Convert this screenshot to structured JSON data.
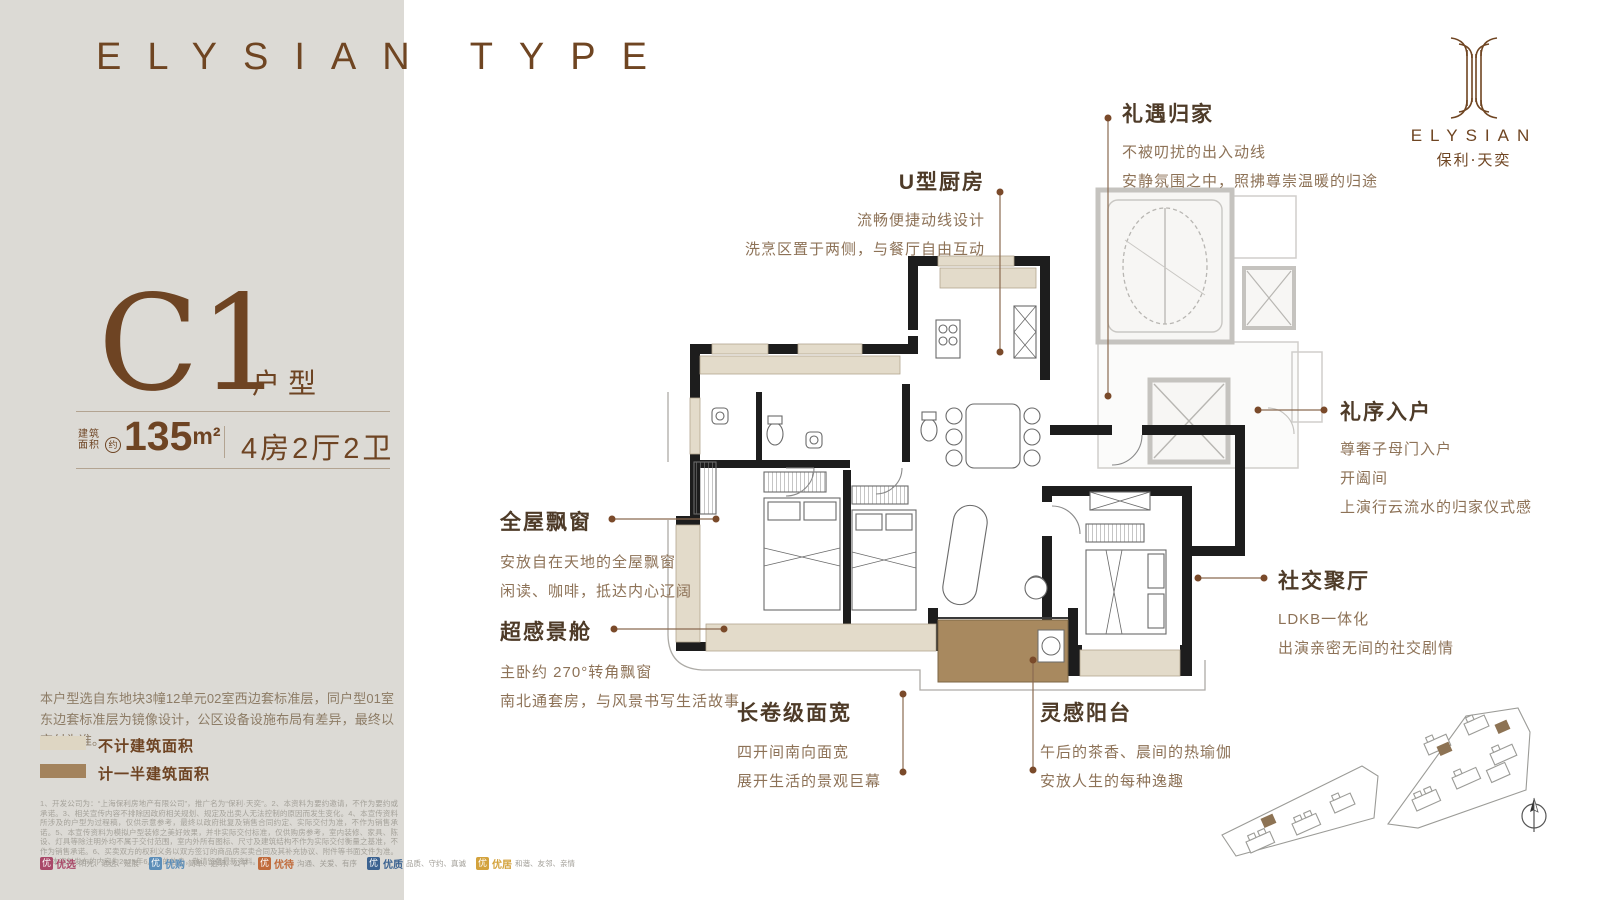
{
  "header": {
    "brand_left": "ELYSIAN",
    "brand_right": "TYPE"
  },
  "logo": {
    "name": "ELYSIAN",
    "cn": "保利·天奕"
  },
  "panel": {
    "plan_code": "C1",
    "plan_type_label": "户型",
    "area_label_1": "建筑",
    "area_label_2": "面积",
    "area_approx": "约",
    "area_value": "135",
    "area_unit": "m²",
    "layout_spec": "4房2厅2卫",
    "disclaimer": "本户型选自东地块3幢12单元02室西边套标准层，同户型01室东边套标准层为镜像设计，公区设备设施布局有差异，最终以交付为准。",
    "legend": [
      {
        "label": "不计建筑面积",
        "color": "#ded6c3"
      },
      {
        "label": "计一半建筑面积",
        "color": "#a3835d"
      }
    ],
    "fine_print": "1、开发公司为：“上海保利房地产有限公司”，推广名为“保利·天奕”。2、本资料为要约邀请，不作为要约或承诺。3、相关宣传内容不排除因政府相关规划、规定及出卖人无法控制的原因而发生变化。4、本宣传资料所涉及的户型为过程稿，仅供示意参考，最终以政府批复及销售合同约定、实际交付为准，不作为销售承诺。5、本宣传资料为模拟户型装修之美好效果，并非实际交付标准，仅供购房参考，室内装修、家具、陈设、灯具等除注明外均不属于交付范围，室内外所有图标、尺寸及建筑结构不作为实际交付衡量之基准，不作为销售承诺。6、买卖双方的权利义务以双方签订的商品房买卖合同及其补充协议、附件等书面文件为准。7、本资料发布的内容为2025年6月前的信息，敬请留意最新资料。",
    "badges": [
      {
        "icon": "优",
        "name": "优选",
        "desc": "阳光、通透、延展",
        "color": "#a94868"
      },
      {
        "icon": "优",
        "name": "优购",
        "desc": "简单、透明、公平",
        "color": "#5b8db8"
      },
      {
        "icon": "优",
        "name": "优待",
        "desc": "沟通、关爱、有序",
        "color": "#c06a3a"
      },
      {
        "icon": "优",
        "name": "优质",
        "desc": "品质、守约、真诚",
        "color": "#3c6391"
      },
      {
        "icon": "优",
        "name": "优居",
        "desc": "和谐、友邻、亲情",
        "color": "#d3a23c"
      }
    ]
  },
  "callouts": {
    "homecoming": {
      "title": "礼遇归家",
      "line1": "不被叨扰的出入动线",
      "line2": "安静氛围之中，照拂尊崇温暖的归途"
    },
    "kitchen": {
      "title": "U型厨房",
      "line1": "流畅便捷动线设计",
      "line2": "洗烹区置于两侧，与餐厅自由互动"
    },
    "entry": {
      "title": "礼序入户",
      "line1": "尊奢子母门入户",
      "line2": "开阖间",
      "line3": "上演行云流水的归家仪式感"
    },
    "baywindow": {
      "title": "全屋飘窗",
      "line1": "安放自在天地的全屋飘窗",
      "line2": "闲读、咖啡，抵达内心辽阔"
    },
    "viewcabin": {
      "title": "超感景舱",
      "line1": "主卧约 270°转角飘窗",
      "line2": "南北通套房，与风景书写生活故事"
    },
    "social": {
      "title": "社交聚厅",
      "line1": "LDKB一体化",
      "line2": "出演亲密无间的社交剧情"
    },
    "facade": {
      "title": "长卷级面宽",
      "line1": "四开间南向面宽",
      "line2": "展开生活的景观巨幕"
    },
    "balcony": {
      "title": "灵感阳台",
      "line1": "午后的茶香、晨间的热瑜伽",
      "line2": "安放人生的每种逸趣"
    }
  }
}
